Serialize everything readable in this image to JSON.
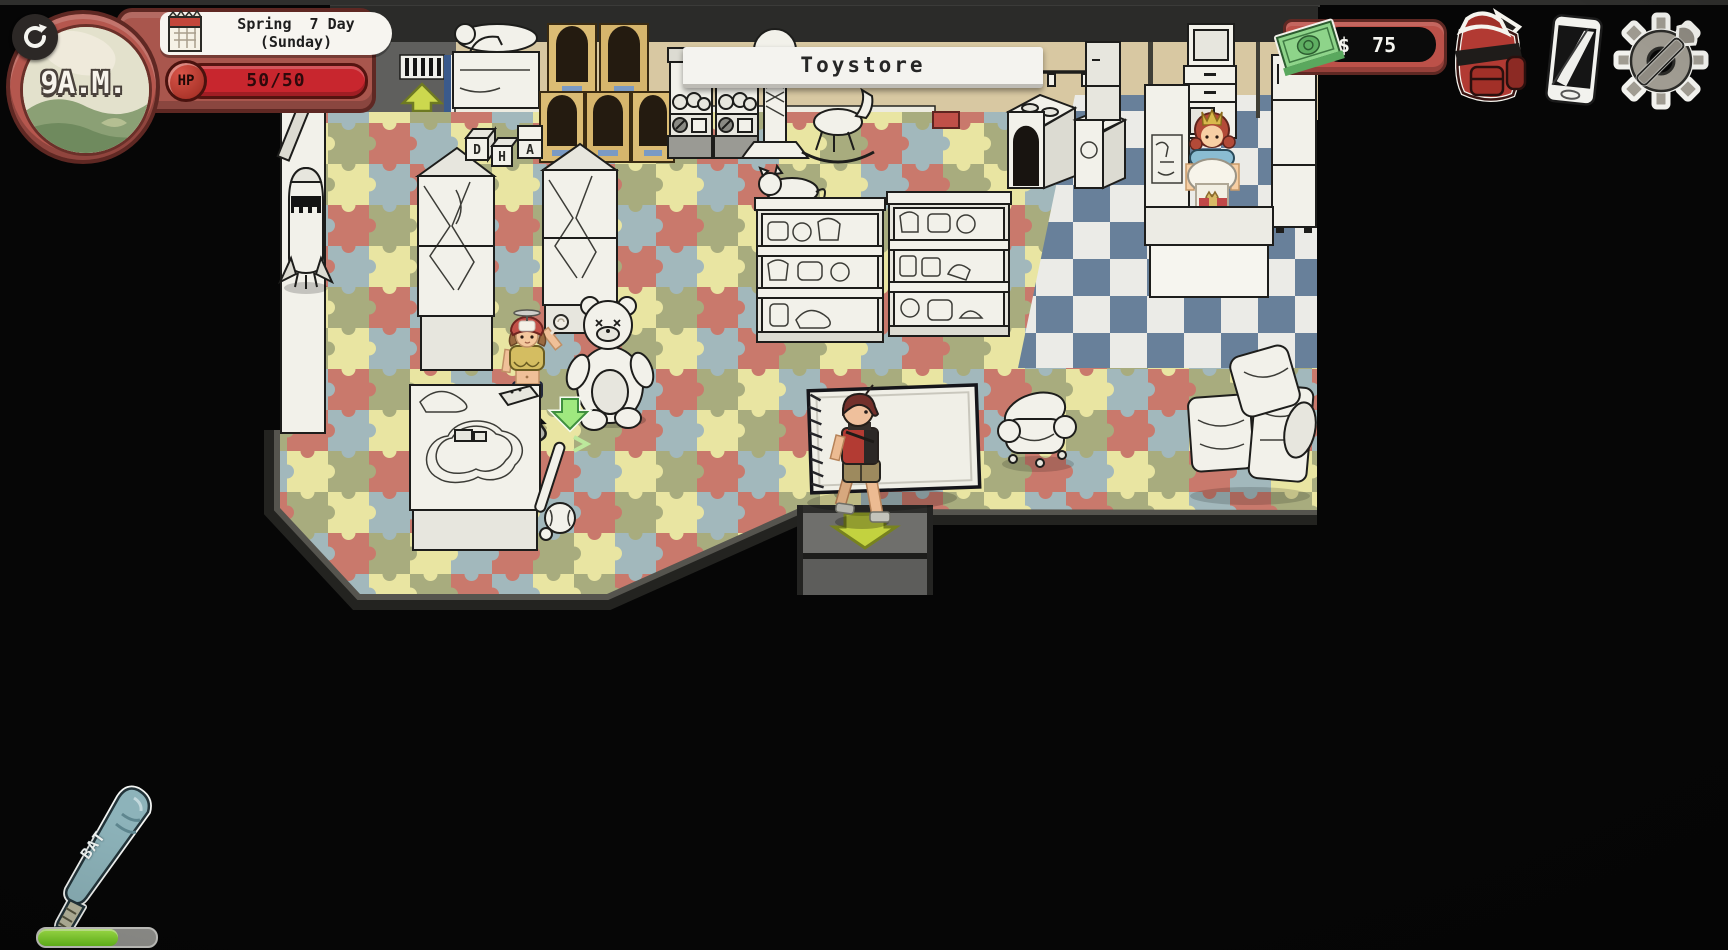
{
  "hud": {
    "time": {
      "value": "9A.M."
    },
    "date": {
      "line1": "Spring  7 Day",
      "line2": "(Sunday)"
    },
    "hp": {
      "label": "HP",
      "value": "50/50"
    },
    "location": {
      "name": "Toystore"
    },
    "money": {
      "currency": "$",
      "amount": "75"
    },
    "toolbar_icons": [
      "money-bill-icon",
      "backpack-icon",
      "phone-icon",
      "gear-wrench-icon"
    ],
    "clock_icon": "refresh-arrow-icon"
  },
  "hotbar": {
    "item_label": "BAT",
    "durability_pct": 68,
    "durability_style": "width:68%"
  },
  "scene": {
    "location_name": "Toystore",
    "blocks_letters": [
      "D",
      "H",
      "A"
    ],
    "npcs": [
      "propeller-cap-girl",
      "shopkeeper"
    ],
    "player": "boy-carrying-rug",
    "markers": [
      "entrance-up-arrow",
      "npc-down-arrow",
      "exit-down-arrow",
      "mouse-cursor"
    ]
  },
  "colors": {
    "hud_frame_red": "#a9564d",
    "hp_bar_red": "#c8262e",
    "money_green": "#8ed48a",
    "arrow_yellow_green": "#c3d23f",
    "npc_arrow_green": "#9fe87f",
    "puzzle_floor": [
      "#c9796c",
      "#e9e5a2",
      "#a2b8bc",
      "#a8ac7e"
    ],
    "checker_floor": [
      "#ebebe7",
      "#68809a"
    ],
    "wall_tan": "#d8c8a2",
    "bat_teal": "#8db3ba"
  }
}
